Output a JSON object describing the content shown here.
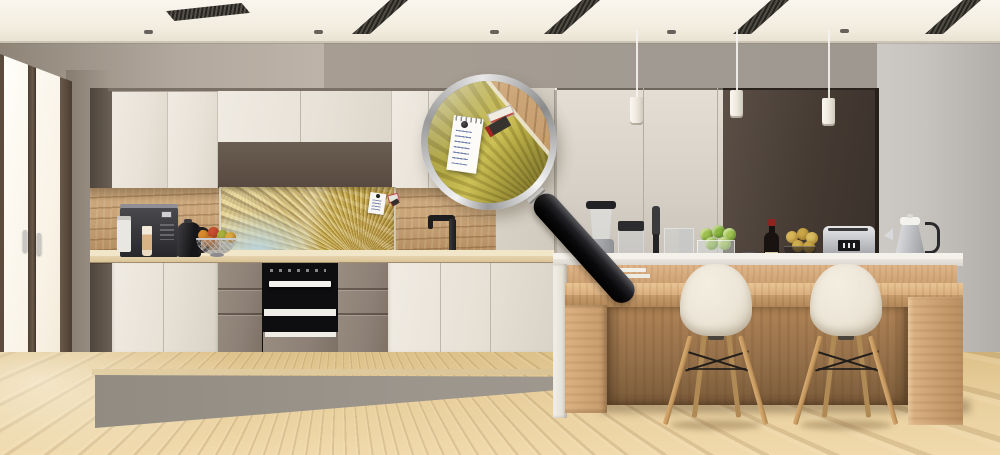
{
  "scene": {
    "kind": "kitchen-interior-product-photo",
    "description": "Modern kitchen render; a magnifying glass enlarges the gold abstract-wave glass splashback panel where a spiral notepad is pinned with a black magnet next to two ticket magnets.",
    "visible_text": "none (notepad handwriting is illegible scribble)",
    "objects": [
      "window",
      "ceiling-vents",
      "ceiling-spotlights",
      "pendant-lights",
      "upper-cabinets",
      "wood-backsplash",
      "glass-splashback-panel",
      "pinned-notepad",
      "fridge-magnets",
      "coffee-machine",
      "black-kettle",
      "fruit-bowl",
      "built-in-oven",
      "faucet",
      "tall-cabinets",
      "blender",
      "food-chopper",
      "hand-blender",
      "apples-bowl",
      "wine-bottle",
      "wine-glasses",
      "pears-bowl",
      "toaster",
      "steel-kettle",
      "kitchen-island",
      "wood-bar-counter",
      "eames-chairs",
      "wood-floor",
      "grey-walkway",
      "magnifying-glass"
    ]
  },
  "palette": {
    "ceiling": "#f7f2e8",
    "wall_left": "#b2a89d",
    "wall_back": "#a89d92",
    "wall_right": "#c6c2bd",
    "cabinet_cream": "#e8e2d8",
    "cabinet_dark": "#57493f",
    "cabinet_taupe": "#8d8076",
    "wood_backsplash": "#c9a478",
    "panel_gold": "#c2a94b",
    "panel_blue": "#bcd6e0",
    "counter_cream": "#f2e6c8",
    "counter_white": "#f5f2eb",
    "island_wood": "#d8ae7e",
    "chair_shell": "#ece5d7",
    "chair_leg": "#c79a62",
    "floor_wood": "#e8cf9d",
    "walkway_grey": "#9b958c",
    "appliance_black": "#1b1b1d",
    "steel": "#c9cacd",
    "wine_red_cap": "#8e2420",
    "apple_green": "#9dbf4d",
    "lens_olive": "#b3a743"
  }
}
